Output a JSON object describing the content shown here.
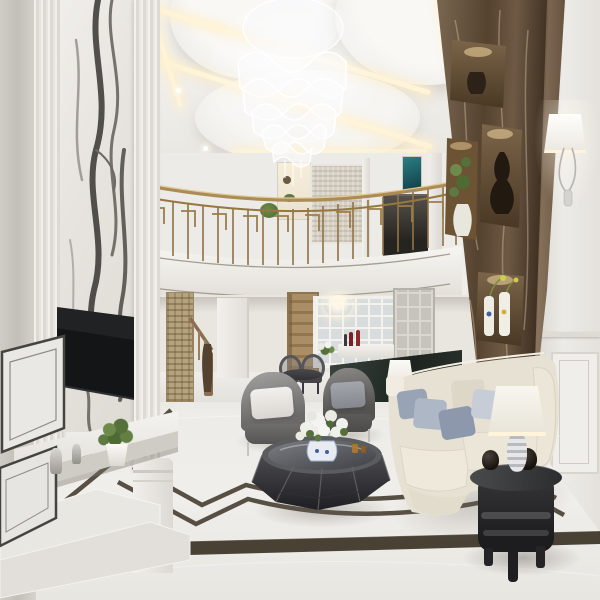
{
  "meta": {
    "title": "Luxury double-height living room interior rendering",
    "type": "3d-interior-render",
    "style": "modern neoclassical",
    "width_px": 600,
    "height_px": 600
  },
  "palette": {
    "ceiling_white": "#f7f6f3",
    "wall_white": "#ecebe7",
    "cove_light": "#fff3d8",
    "marble_white": "#eceae7",
    "marble_vein_dark": "#3f3e3a",
    "marble_brown_dark": "#55422f",
    "marble_brown_light": "#7a6750",
    "railing_gold": "#ab8b58",
    "sofa_cream": "#e7e1d3",
    "pillow_blue_gray": "#98a3b6",
    "armchair_gray": "#8a8987",
    "coffee_table_dark": "#2f2f33",
    "floor_white": "#eeece8",
    "floor_inlay_dark": "#4a4135",
    "teal_artwork": "#2a7f85",
    "stair_wood": "#a98e66",
    "plant_green": "#5d7a42",
    "lamp_shade": "#f8f6ef",
    "tv_black": "#141517"
  },
  "scene": {
    "ceiling": {
      "description": "ornate white tray ceiling with curved petal moldings, warm LED cove strips and recessed spotlights",
      "spotlight_count": 9,
      "cove_strip_count": 5
    },
    "chandelier": {
      "type": "tiered wavy crystal chandelier",
      "tiers": 5,
      "color": "#ffffff"
    },
    "mezzanine": {
      "railing_style": "geometric brass balustrade with meander pattern",
      "fascia": "white curved band with double trim lines",
      "back_wall_items": [
        "white built-in cabinet with lit shelves",
        "beige mosaic panel",
        "teal artwork",
        "dark wood console",
        "small green plant"
      ]
    },
    "left_wall": {
      "material": "white panda marble slab with black veining",
      "elements": [
        "gray mirror-trim pilaster",
        "fluted white pilasters",
        "metal-trim wainscot panels",
        "wall-mounted flat TV",
        "white marble media ledge",
        "marble plinth and steps"
      ],
      "ledge_decor": [
        "green plant in white pot",
        "two silver vases"
      ]
    },
    "right_wall": {
      "material": "dark emperador brown marble feature wall",
      "niche_count": 4,
      "niche_contents": [
        "lit display objects",
        "green plant with white vase",
        "dark sculptural vase",
        "two white bottles with yellow flowers"
      ],
      "sconce": "white trapezoid shade with chrome arms",
      "wainscot": "white panel moulding"
    },
    "background_ground_floor": {
      "items": [
        "carved wood stair screen",
        "wood staircase with figurine newel post",
        "white door",
        "carved wood door",
        "glazed french doors",
        "glass display cabinet",
        "white bar counter with wine bottles",
        "flower bouquet",
        "mini crystal chandelier",
        "dark green marble counter",
        "two oval-back dining chairs",
        "round dining table"
      ]
    },
    "floor": {
      "material": "polished white marble",
      "pattern": "dark marble inlay medallion bands and straight border strip"
    },
    "furniture": {
      "sofa": {
        "color": "#e7e1d3",
        "pillow_colors": [
          "#98a3b6",
          "#aeb7c6",
          "#ddd7c8",
          "#8d98ac",
          "#c7cdd6"
        ],
        "seats": 3
      },
      "armchairs": [
        {
          "color": "#8a8987",
          "pillow": "#f2f0ec"
        },
        {
          "color": "#6f6e6c",
          "pillow": "#9aa0a8"
        }
      ],
      "coffee_table": {
        "style": "faceted diamond drum with glass top",
        "color": "#2f2f33",
        "decor": "white hydrangeas in blue-white porcelain vase, two amber cups"
      },
      "side_table": {
        "color": "#252527",
        "items": [
          "white drum-shade lamp with crystal base",
          "two dark round vases"
        ]
      },
      "console_lamp": {
        "shade": "#f7f5f0"
      }
    }
  }
}
